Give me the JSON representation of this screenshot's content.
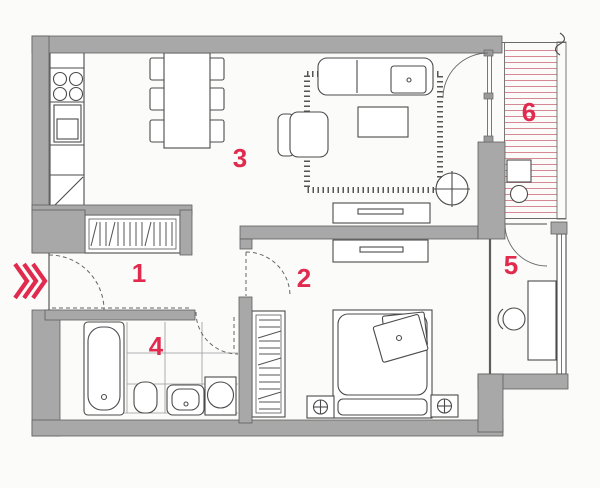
{
  "rooms": [
    {
      "label": "1"
    },
    {
      "label": "2"
    },
    {
      "label": "3"
    },
    {
      "label": "4"
    },
    {
      "label": "5"
    },
    {
      "label": "6"
    }
  ],
  "entrance": {
    "marker": "triple-chevron",
    "direction": "right"
  },
  "colors": {
    "label_red": "#e02a4e",
    "stripe_pink": "#d68894",
    "wall_gray": "#a8a8a8",
    "line_dark": "#4b4b4b"
  }
}
